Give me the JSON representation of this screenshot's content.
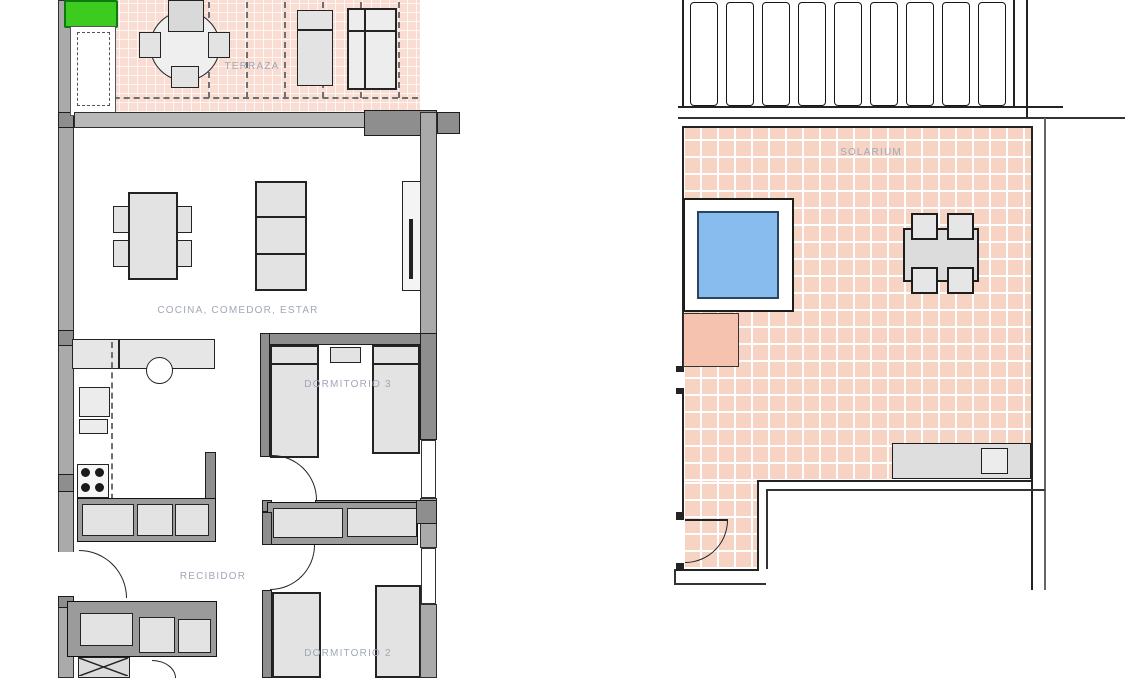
{
  "document_title": "Apartment floor plans",
  "colors": {
    "wall": "#aaaaaa",
    "wall_dark": "#8e8e8e",
    "furniture": "#e3e3e3",
    "terrace_tile": "#f9dcd2",
    "solarium_tile": "#f7d3c4",
    "pool_water": "#88bbee",
    "pool_border": "#2b4560",
    "salmon": "#f6c2b0",
    "planter_green": "#3ecb1f",
    "label_text": "#a0a7b8",
    "line": "#232323"
  },
  "ground_floor": {
    "labels": {
      "terrace": "TERRAZA",
      "living": "COCINA, COMEDOR, ESTAR",
      "bedroom3": "DORMITORIO 3",
      "hall": "RECIBIDOR",
      "bedroom2": "DORMITORIO 2"
    }
  },
  "roof_floor": {
    "labels": {
      "solarium": "SOLARIUM"
    }
  }
}
